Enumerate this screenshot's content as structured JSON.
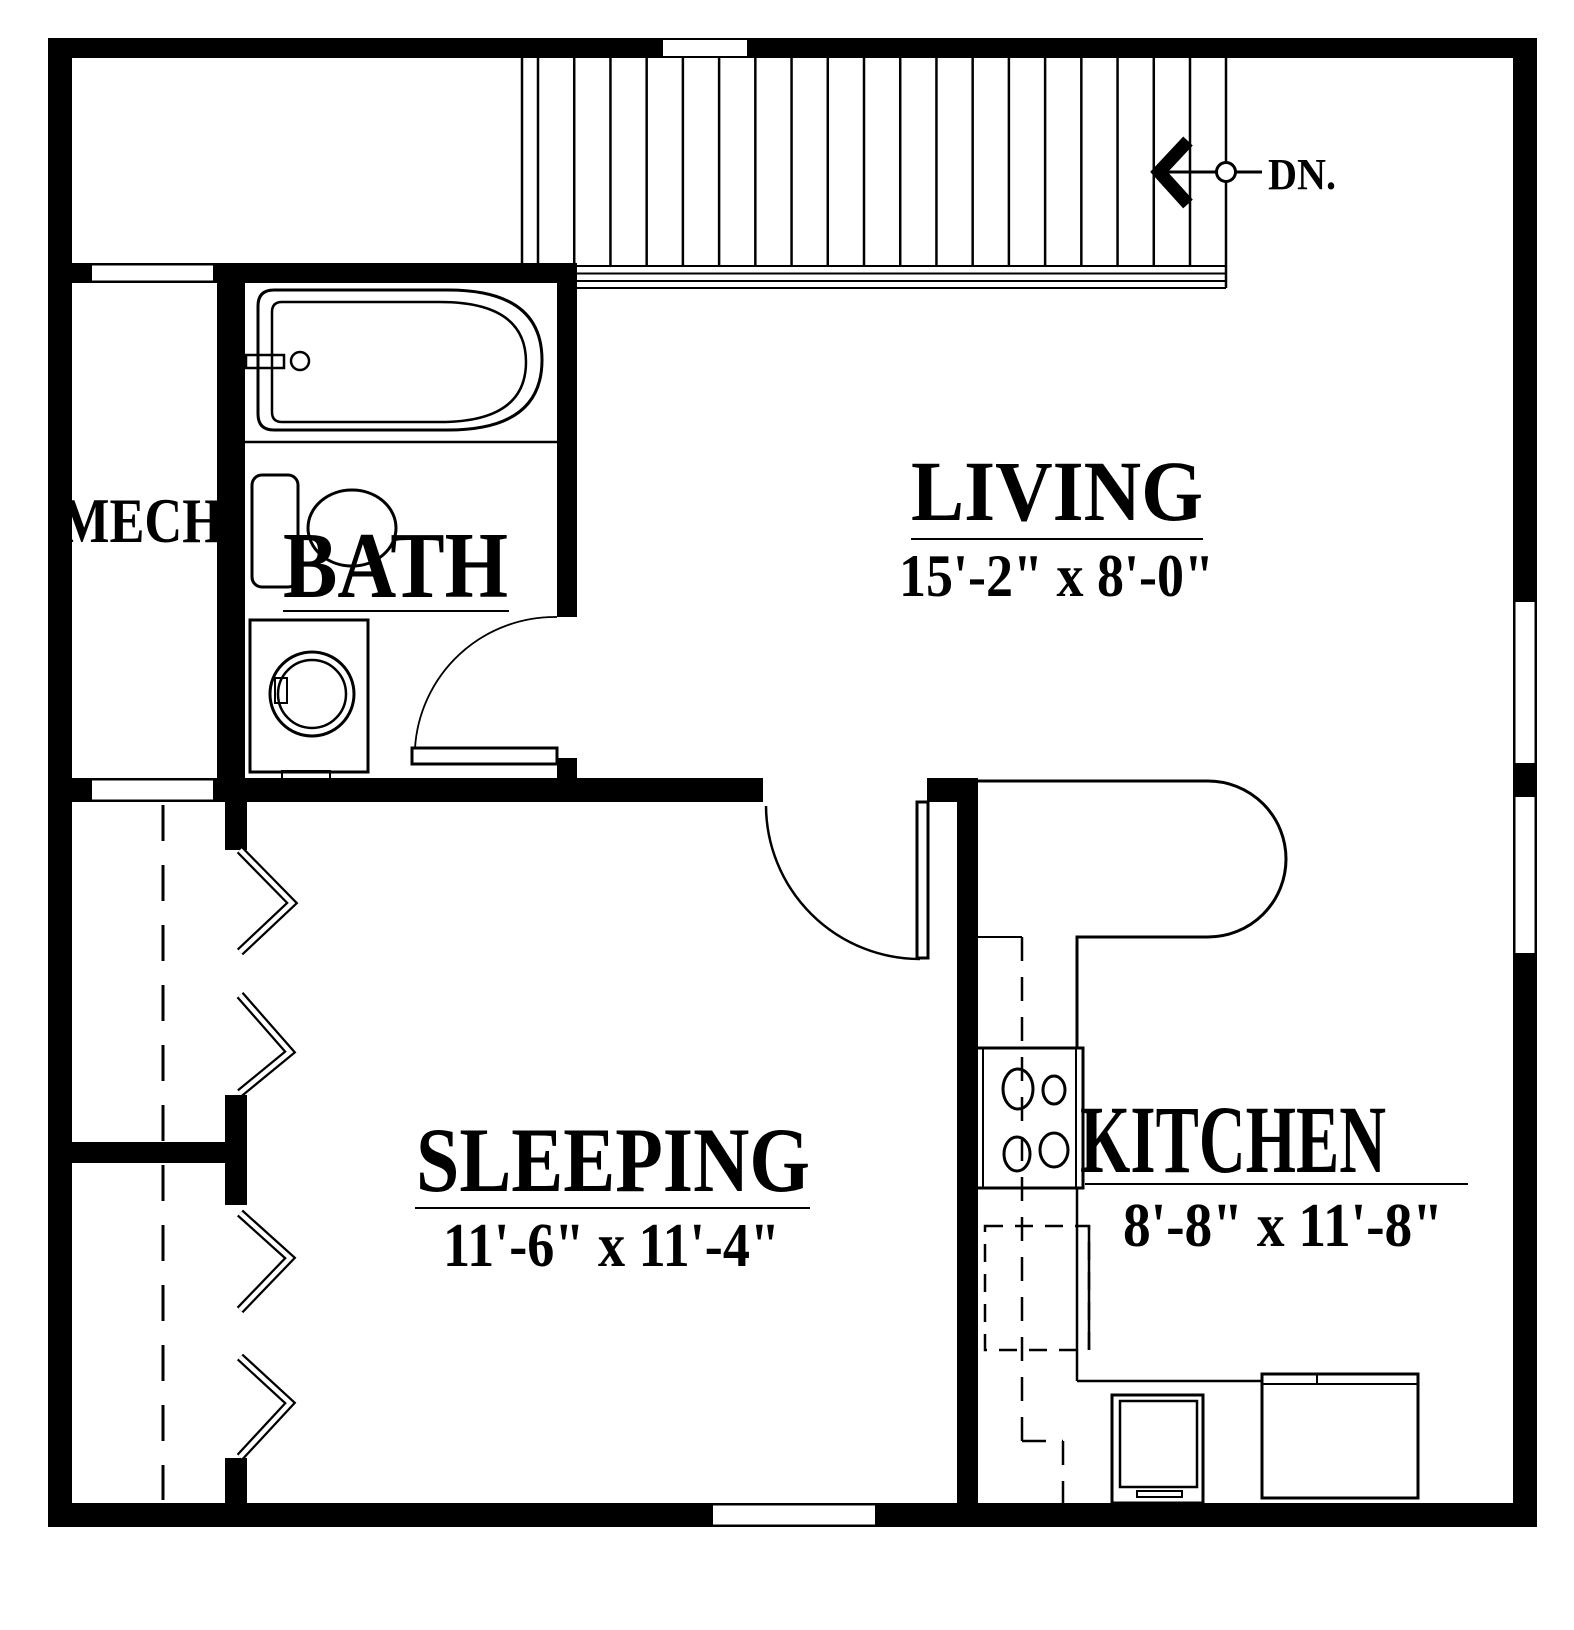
{
  "plan_type": "apartment-upper-floor-plan",
  "rooms": {
    "living": {
      "label": "LIVING",
      "dims": "15'-2\" x 8'-0\""
    },
    "sleeping": {
      "label": "SLEEPING",
      "dims": "11'-6\" x 11'-4\""
    },
    "kitchen": {
      "label": "KITCHEN",
      "dims": "8'-8\" x 11'-8\""
    },
    "bath": {
      "label": "BATH"
    },
    "mech": {
      "label": "MECH"
    }
  },
  "stairs": {
    "down_label": "DN.",
    "tread_count": 19
  },
  "fixtures": [
    "bathtub",
    "toilet",
    "washing-machine",
    "range-4-burner",
    "kitchen-peninsula-counter",
    "refrigerator",
    "sink-appliance",
    "bifold-closet-doors",
    "closet-rod-dashed",
    "door-swings",
    "stair-run",
    "windows"
  ],
  "colors": {
    "ink": "#000000",
    "paper": "#ffffff"
  }
}
